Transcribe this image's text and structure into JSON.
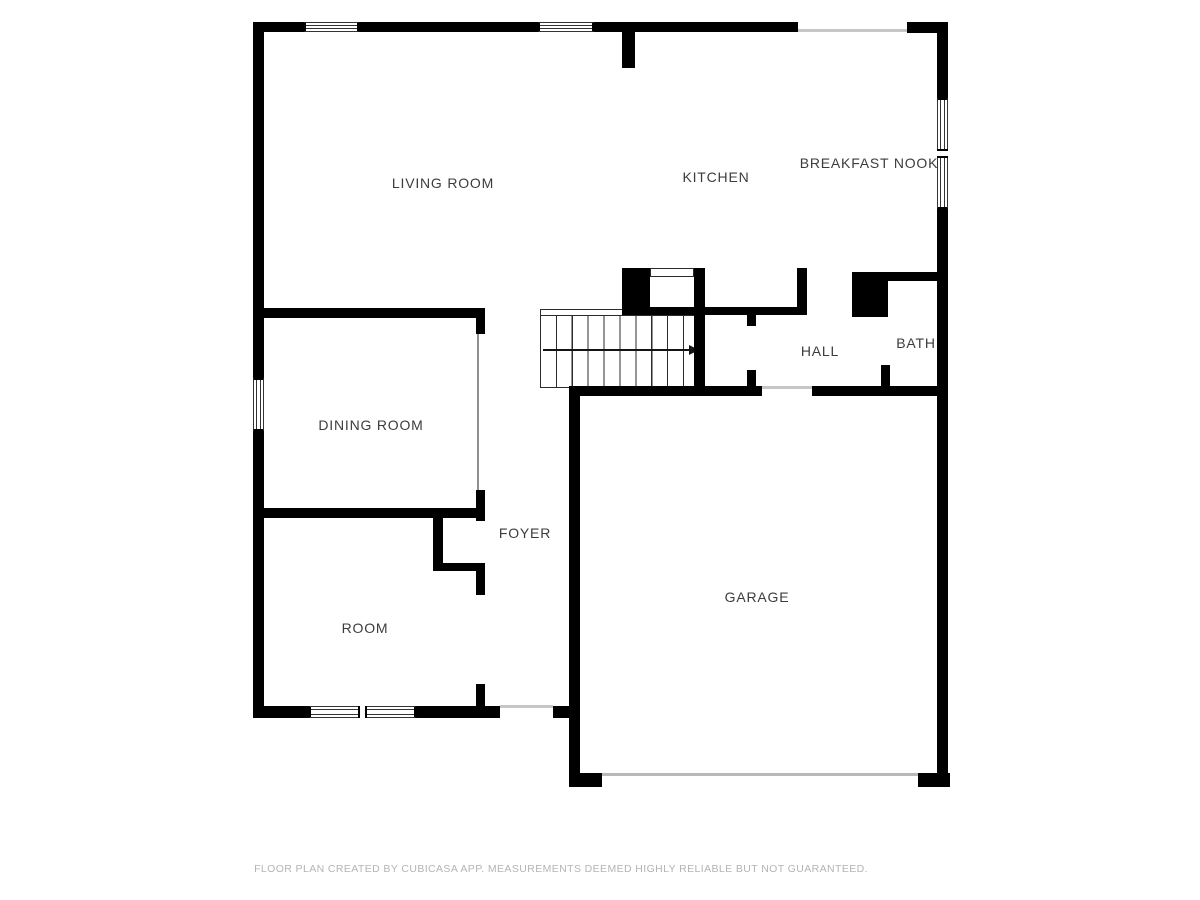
{
  "plan": {
    "rooms": [
      {
        "id": "living-room",
        "label": "LIVING ROOM"
      },
      {
        "id": "kitchen",
        "label": "KITCHEN"
      },
      {
        "id": "breakfast-nook",
        "label": "BREAKFAST NOOK"
      },
      {
        "id": "hall",
        "label": "HALL"
      },
      {
        "id": "bath",
        "label": "BATH"
      },
      {
        "id": "dining-room",
        "label": "DINING ROOM"
      },
      {
        "id": "foyer",
        "label": "FOYER"
      },
      {
        "id": "room",
        "label": "ROOM"
      },
      {
        "id": "garage",
        "label": "GARAGE"
      }
    ],
    "stairs": {
      "direction_icon": "arrow-right"
    }
  },
  "footer": {
    "disclaimer": "FLOOR PLAN CREATED BY CUBICASA APP. MEASUREMENTS DEEMED HIGHLY RELIABLE BUT NOT GUARANTEED."
  },
  "colors": {
    "wall": "#000000",
    "label_text": "#3c3c3c",
    "footer_text": "#b4b4b4",
    "opening_line": "#c6c6c6",
    "background": "#ffffff"
  }
}
